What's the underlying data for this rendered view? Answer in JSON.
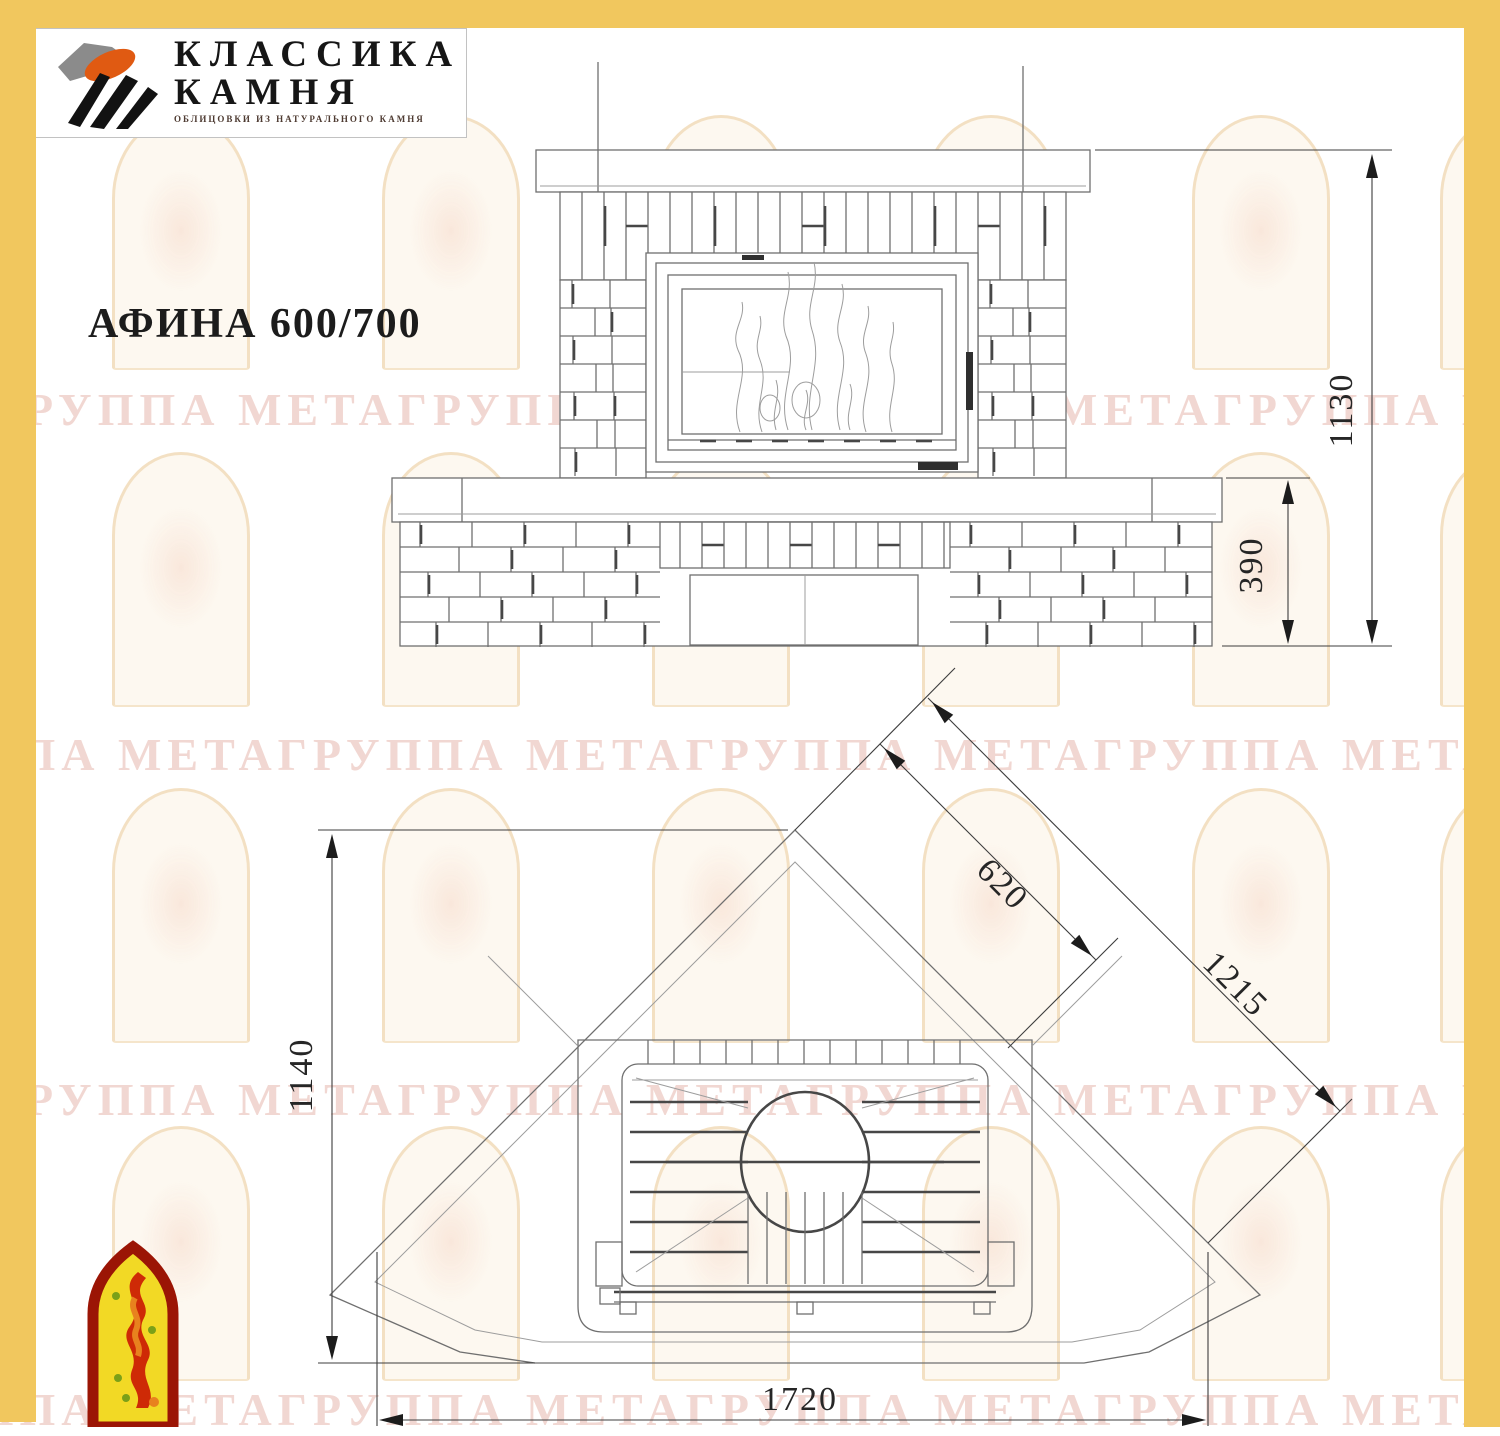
{
  "page": {
    "background": "#ffffff"
  },
  "frame": {
    "color": "#f1c75e"
  },
  "header_logo": {
    "line1": "КЛАССИКА",
    "line2": "КАМНЯ",
    "tagline": "ОБЛИЦОВКИ ИЗ НАТУРАЛЬНОГО КАМНЯ",
    "icon": "stone-logo-icon",
    "icon_colors": {
      "gray": "#8b8b8b",
      "orange": "#e05a12",
      "black": "#121212"
    }
  },
  "title": "АФИНА 600/700",
  "watermark": {
    "text": "МЕТАГРУППА",
    "text_color": "#e5b1a6",
    "rows_top": [
      383,
      728,
      1073,
      1383
    ],
    "arch_rows_top": [
      115,
      452,
      788,
      1126
    ],
    "arch_cols_left": [
      112,
      382,
      652,
      922,
      1192,
      1440
    ]
  },
  "drawing": {
    "type": "fireplace technical drawing",
    "views": [
      "front elevation",
      "top plan (corner placement)"
    ],
    "dimensions_mm": {
      "front_total_height": "1130",
      "front_base_height": "390",
      "plan_depth": "1140",
      "plan_front_width": "1720",
      "plan_inner_diagonal": "620",
      "plan_outer_diagonal": "1215"
    }
  },
  "corner_logo": {
    "icon": "flame-arch-icon",
    "border": "#9b1505",
    "fill": "#f2d925",
    "flame": "#ce2a06"
  }
}
